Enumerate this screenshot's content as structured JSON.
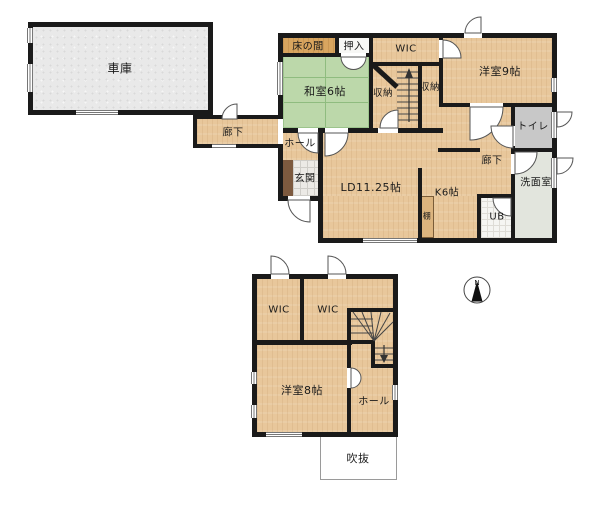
{
  "plan": {
    "floor1": {
      "garage": "車庫",
      "corridor_garage": "廊下",
      "tokonoma": "床の間",
      "oshiire": "押入",
      "washitsu": "和室6帖",
      "wic": "WIC",
      "storage_left": "収納",
      "storage_right": "収納",
      "bedroom9": "洋室9帖",
      "toilet": "トイレ",
      "hall": "ホール",
      "entrance": "玄関",
      "living_dining": "LD11.25帖",
      "corridor": "廊下",
      "kitchen": "K6帖",
      "shelf": "棚",
      "washroom": "洗面室",
      "bath": "UB"
    },
    "floor2": {
      "wic_left": "WIC",
      "wic_right": "WIC",
      "bedroom8": "洋室8帖",
      "hall": "ホール",
      "void": "吹抜"
    },
    "compass": {
      "label": "N"
    }
  },
  "colors": {
    "wall": "#1a1a1a",
    "wood_floor": "#e8c79b",
    "tatami": "#bcd8aa",
    "tokonoma": "#d8a55f",
    "garage": "#e9e9e9",
    "toilet": "#c8c8c8",
    "washroom": "#e2e5dd",
    "entrance_step": "#7d5a3f",
    "background": "#ffffff"
  }
}
